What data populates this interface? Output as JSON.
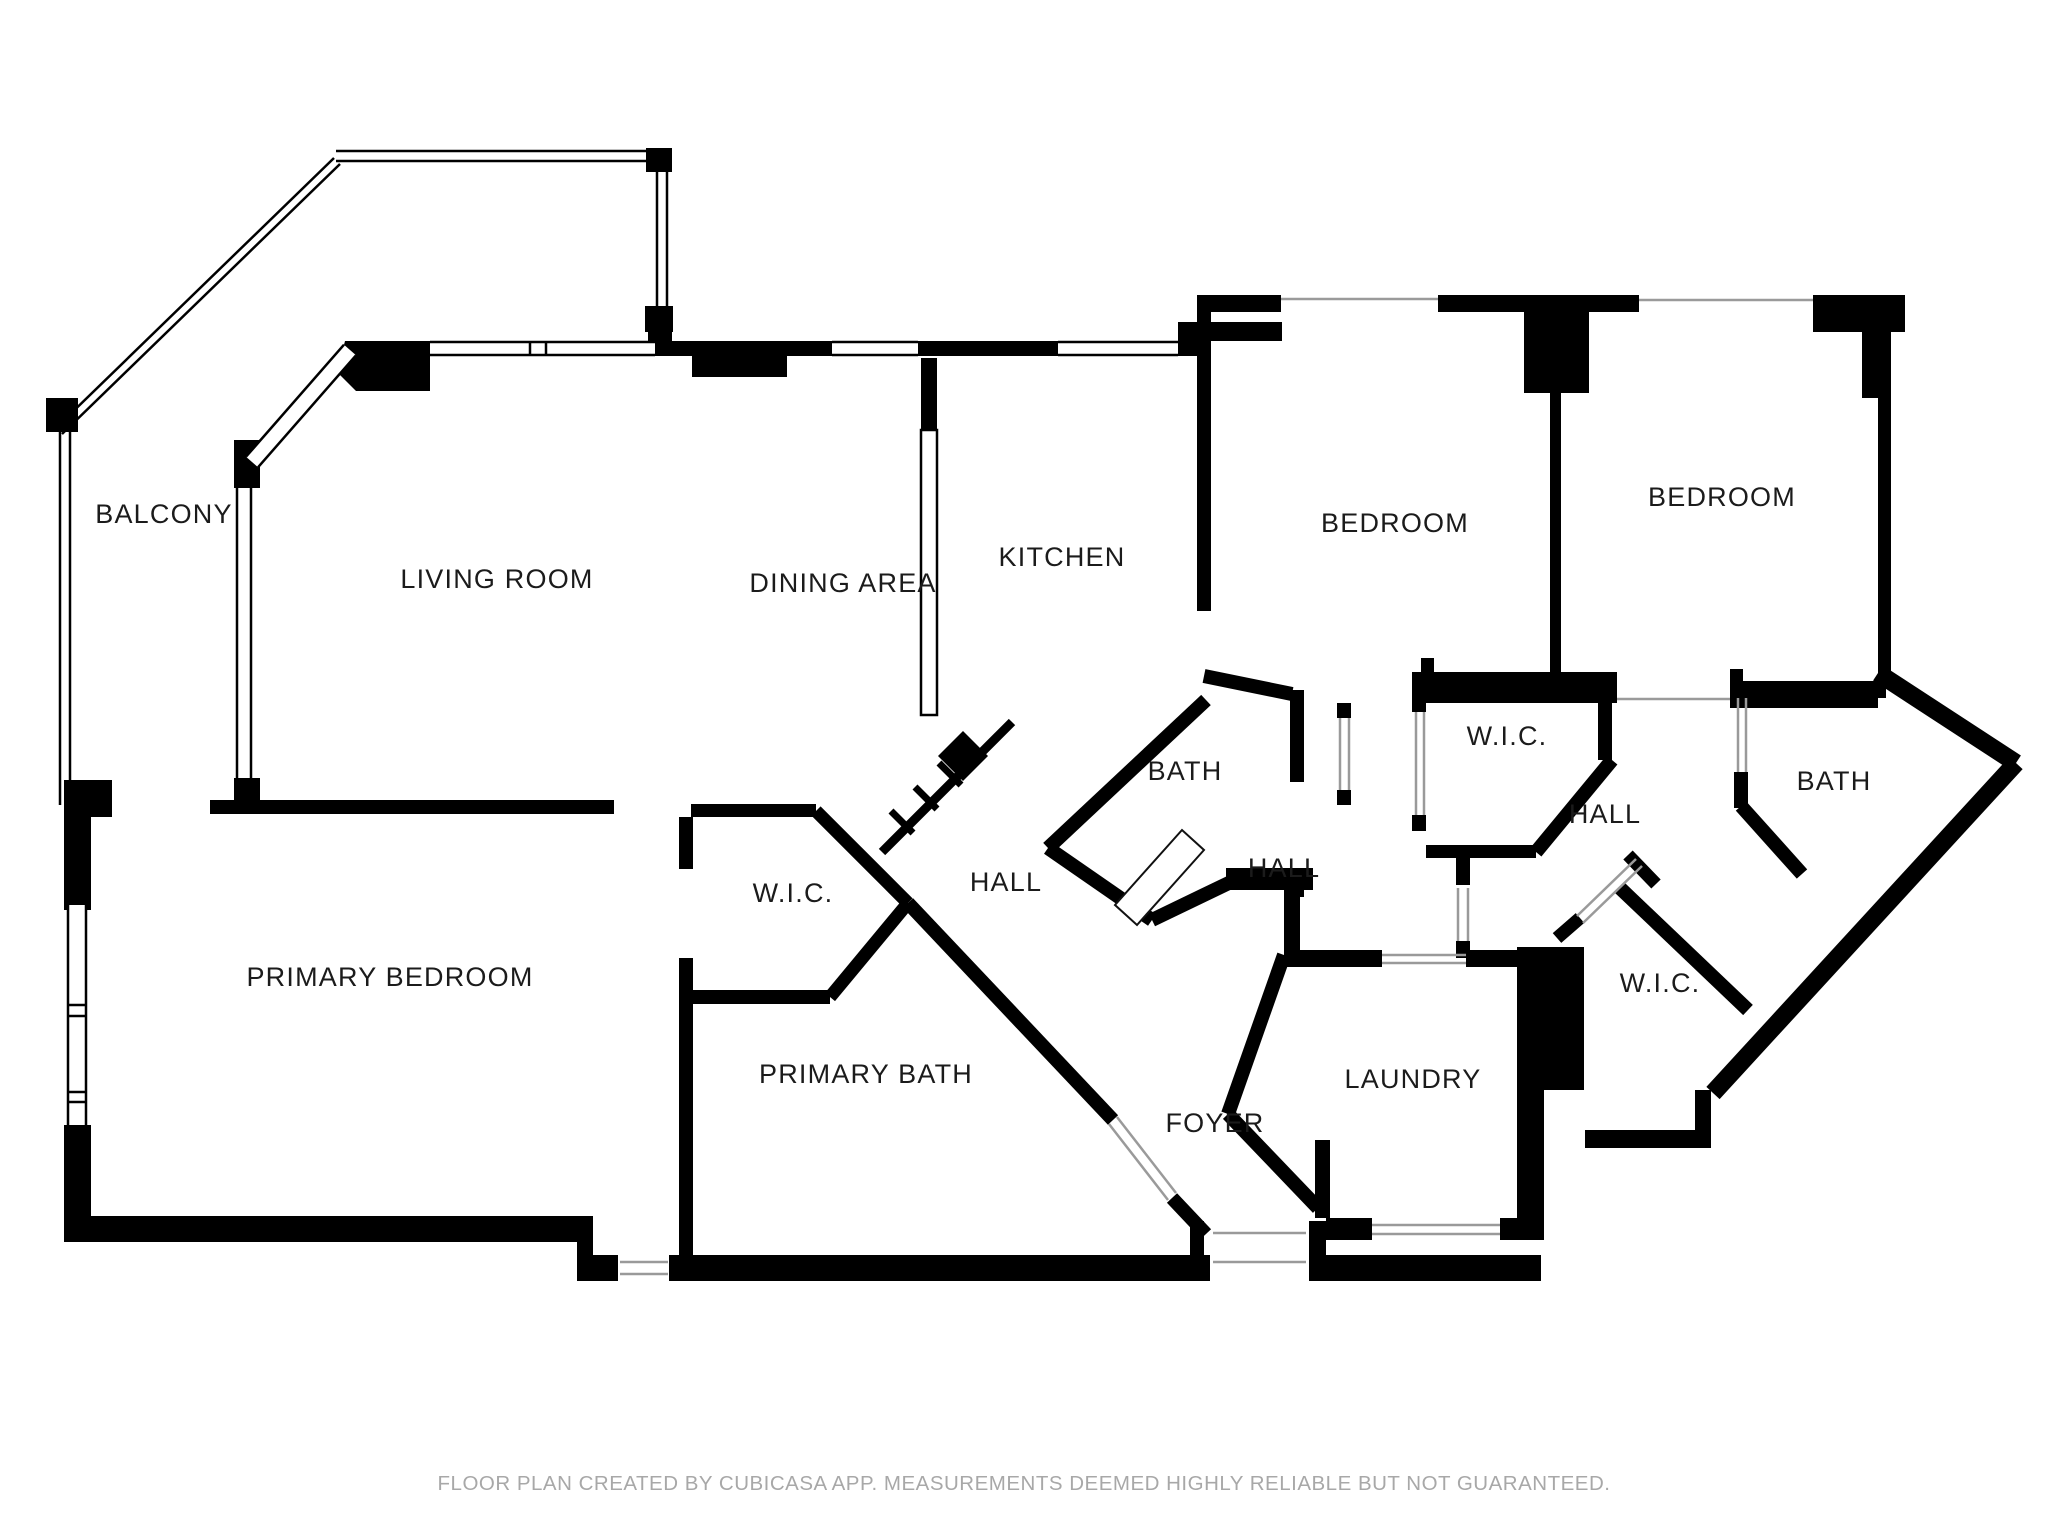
{
  "meta": {
    "canvas_w": 2048,
    "canvas_h": 1536,
    "bg_color": "#ffffff",
    "wall_color": "#000000",
    "label_color": "#1b1b1b",
    "thin_color": "#9a9a9a",
    "label_font_size": 27,
    "footer_font_size": 20.5
  },
  "footer": {
    "text": "FLOOR PLAN CREATED BY CUBICASA APP. MEASUREMENTS DEEMED HIGHLY RELIABLE BUT NOT GUARANTEED.",
    "y": 1472
  },
  "rooms": [
    {
      "id": "balcony",
      "label": "BALCONY",
      "x": 164,
      "y": 523
    },
    {
      "id": "living-room",
      "label": "LIVING ROOM",
      "x": 497,
      "y": 588
    },
    {
      "id": "dining-area",
      "label": "DINING AREA",
      "x": 843,
      "y": 592
    },
    {
      "id": "kitchen",
      "label": "KITCHEN",
      "x": 1062,
      "y": 566
    },
    {
      "id": "bedroom-1",
      "label": "BEDROOM",
      "x": 1395,
      "y": 532
    },
    {
      "id": "bedroom-2",
      "label": "BEDROOM",
      "x": 1722,
      "y": 506
    },
    {
      "id": "bath-middle",
      "label": "BATH",
      "x": 1185,
      "y": 780
    },
    {
      "id": "wic-top-right",
      "label": "W.I.C.",
      "x": 1507,
      "y": 745
    },
    {
      "id": "hall-right",
      "label": "HALL",
      "x": 1605,
      "y": 823
    },
    {
      "id": "bath-right",
      "label": "BATH",
      "x": 1834,
      "y": 790
    },
    {
      "id": "hall-center",
      "label": "HALL",
      "x": 1284,
      "y": 877
    },
    {
      "id": "hall-left",
      "label": "HALL",
      "x": 1006,
      "y": 891
    },
    {
      "id": "wic-left",
      "label": "W.I.C.",
      "x": 793,
      "y": 902
    },
    {
      "id": "primary-bedroom",
      "label": "PRIMARY BEDROOM",
      "x": 390,
      "y": 986
    },
    {
      "id": "primary-bath",
      "label": "PRIMARY BATH",
      "x": 866,
      "y": 1083
    },
    {
      "id": "foyer",
      "label": "FOYER",
      "x": 1215,
      "y": 1132
    },
    {
      "id": "laundry",
      "label": "LAUNDRY",
      "x": 1413,
      "y": 1088
    },
    {
      "id": "wic-bottom-right",
      "label": "W.I.C.",
      "x": 1660,
      "y": 992
    }
  ],
  "walls": {
    "rects": [
      [
        648,
        323,
        24,
        33
      ],
      [
        668,
        341,
        164,
        15
      ],
      [
        692,
        356,
        95,
        21
      ],
      [
        918,
        341,
        140,
        15
      ],
      [
        1178,
        322,
        104,
        19
      ],
      [
        1178,
        341,
        33,
        15
      ],
      [
        1197,
        295,
        84,
        17
      ],
      [
        1438,
        295,
        201,
        17
      ],
      [
        1524,
        312,
        65,
        81
      ],
      [
        1813,
        295,
        92,
        37
      ],
      [
        1862,
        332,
        29,
        66
      ],
      [
        1878,
        398,
        13,
        275
      ],
      [
        1197,
        312,
        14,
        299
      ],
      [
        921,
        358,
        16,
        72
      ],
      [
        1550,
        393,
        11,
        279
      ],
      [
        1421,
        681,
        196,
        22
      ],
      [
        1421,
        658,
        13,
        23
      ],
      [
        1730,
        687,
        148,
        21
      ],
      [
        1730,
        669,
        13,
        18
      ],
      [
        1412,
        672,
        205,
        18
      ],
      [
        1412,
        690,
        14,
        22
      ],
      [
        1412,
        815,
        14,
        16
      ],
      [
        1426,
        845,
        110,
        13
      ],
      [
        1598,
        690,
        14,
        70
      ],
      [
        1456,
        858,
        14,
        27
      ],
      [
        1456,
        941,
        14,
        17
      ],
      [
        1734,
        681,
        152,
        17
      ],
      [
        1734,
        772,
        14,
        36
      ],
      [
        1226,
        868,
        87,
        22
      ],
      [
        1290,
        690,
        14,
        92
      ],
      [
        1290,
        868,
        14,
        29
      ],
      [
        1337,
        703,
        14,
        15
      ],
      [
        1337,
        790,
        14,
        15
      ],
      [
        64,
        780,
        48,
        37
      ],
      [
        210,
        800,
        404,
        14
      ],
      [
        691,
        804,
        125,
        13
      ],
      [
        679,
        817,
        14,
        52
      ],
      [
        679,
        958,
        14,
        310
      ],
      [
        691,
        990,
        139,
        14
      ],
      [
        64,
        808,
        27,
        102
      ],
      [
        64,
        1125,
        27,
        117
      ],
      [
        64,
        1216,
        529,
        26
      ],
      [
        577,
        1216,
        16,
        65
      ],
      [
        593,
        1255,
        25,
        26
      ],
      [
        669,
        1255,
        541,
        26
      ],
      [
        1190,
        1221,
        14,
        34
      ],
      [
        1309,
        1221,
        17,
        60
      ],
      [
        1309,
        1255,
        232,
        26
      ],
      [
        1284,
        950,
        98,
        17
      ],
      [
        1466,
        950,
        51,
        17
      ],
      [
        1517,
        947,
        67,
        143
      ],
      [
        1517,
        1090,
        27,
        150
      ],
      [
        1326,
        1218,
        46,
        22
      ],
      [
        1500,
        1218,
        44,
        22
      ],
      [
        1585,
        1130,
        123,
        18
      ],
      [
        1695,
        1090,
        16,
        58
      ],
      [
        1284,
        890,
        16,
        60
      ],
      [
        1315,
        1140,
        15,
        78
      ],
      [
        234,
        440,
        26,
        48
      ],
      [
        234,
        778,
        26,
        24
      ],
      [
        646,
        148,
        26,
        24
      ],
      [
        645,
        306,
        28,
        26
      ],
      [
        46,
        398,
        32,
        34
      ]
    ],
    "polys": [
      [
        [
          345,
          341
        ],
        [
          430,
          341
        ],
        [
          430,
          391
        ],
        [
          356,
          391
        ],
        [
          337,
          372
        ]
      ],
      [
        [
          963,
          731
        ],
        [
          988,
          756
        ],
        [
          963,
          781
        ],
        [
          938,
          756
        ]
      ]
    ],
    "segs": [
      [
        1206,
        700,
        1048,
        848,
        14
      ],
      [
        1048,
        848,
        1152,
        920,
        14
      ],
      [
        1152,
        920,
        1235,
        880,
        14
      ],
      [
        1204,
        676,
        1292,
        694,
        14
      ],
      [
        816,
        811,
        908,
        903,
        13
      ],
      [
        908,
        903,
        830,
        997,
        13
      ],
      [
        908,
        903,
        1113,
        1120,
        14
      ],
      [
        1172,
        1198,
        1206,
        1234,
        14
      ],
      [
        1284,
        955,
        1228,
        1114,
        14
      ],
      [
        1228,
        1114,
        1318,
        1208,
        14
      ],
      [
        1620,
        888,
        1748,
        1010,
        14
      ],
      [
        1628,
        855,
        1656,
        884,
        13
      ],
      [
        1557,
        938,
        1580,
        918,
        13
      ],
      [
        1741,
        806,
        1802,
        874,
        14
      ],
      [
        1878,
        673,
        2016,
        763,
        18
      ],
      [
        2016,
        763,
        1713,
        1093,
        18
      ],
      [
        1536,
        852,
        1612,
        760,
        14
      ],
      [
        1012,
        722,
        882,
        852,
        9
      ],
      [
        939,
        763,
        961,
        785,
        7
      ],
      [
        915,
        787,
        937,
        809,
        7
      ],
      [
        891,
        811,
        913,
        833,
        7
      ]
    ],
    "thin_segs": [
      [
        1281,
        299,
        1438,
        299
      ],
      [
        1639,
        300,
        1813,
        300
      ],
      [
        1617,
        699,
        1730,
        699
      ],
      [
        1382,
        955,
        1466,
        955
      ],
      [
        1382,
        963,
        1466,
        963
      ],
      [
        1372,
        1225,
        1500,
        1225
      ],
      [
        1372,
        1234,
        1500,
        1234
      ],
      [
        1213,
        1233,
        1306,
        1233
      ],
      [
        1213,
        1262,
        1306,
        1262
      ],
      [
        1109,
        1124,
        1168,
        1200
      ],
      [
        1117,
        1117,
        1176,
        1193
      ],
      [
        1577,
        916,
        1636,
        859
      ],
      [
        1583,
        923,
        1642,
        866
      ],
      [
        1458,
        888,
        1458,
        941
      ],
      [
        1468,
        888,
        1468,
        941
      ],
      [
        1340,
        718,
        1340,
        790
      ],
      [
        1349,
        718,
        1349,
        790
      ],
      [
        1416,
        712,
        1416,
        815
      ],
      [
        1424,
        712,
        1424,
        815
      ],
      [
        1738,
        698,
        1738,
        772
      ],
      [
        1746,
        698,
        1746,
        772
      ],
      [
        620,
        1262,
        668,
        1262
      ],
      [
        620,
        1274,
        668,
        1274
      ]
    ],
    "door_leaf": [
      [
        1115,
        905
      ],
      [
        1182,
        830
      ],
      [
        1204,
        850
      ],
      [
        1137,
        925
      ]
    ]
  },
  "windows": {
    "horizontal": [
      {
        "x": 430,
        "y": 341,
        "w": 225,
        "h": 15,
        "mullions": [
          530,
          546
        ]
      },
      {
        "x": 832,
        "y": 341,
        "w": 86,
        "h": 15,
        "mullions": []
      },
      {
        "x": 1058,
        "y": 341,
        "w": 120,
        "h": 15,
        "mullions": []
      }
    ],
    "vertical": [
      {
        "x": 236,
        "y": 488,
        "w": 16,
        "h": 290,
        "mullions": []
      },
      {
        "x": 67,
        "y": 905,
        "w": 20,
        "h": 220,
        "mullions": [
          1005,
          1016,
          1092,
          1102
        ]
      }
    ],
    "diagonal": [
      {
        "x1": 252,
        "y1": 462,
        "x2": 350,
        "y2": 350,
        "w": 16
      }
    ]
  },
  "railings": {
    "lines": [
      [
        56,
        428,
        334,
        158
      ],
      [
        62,
        434,
        340,
        164
      ],
      [
        336,
        151,
        652,
        151
      ],
      [
        336,
        161,
        652,
        161
      ],
      [
        657,
        170,
        657,
        308
      ],
      [
        667,
        170,
        667,
        308
      ],
      [
        60,
        430,
        60,
        805
      ],
      [
        70,
        430,
        70,
        805
      ]
    ]
  },
  "counters": [
    {
      "x": 921,
      "y": 430,
      "w": 16,
      "h": 285
    }
  ]
}
